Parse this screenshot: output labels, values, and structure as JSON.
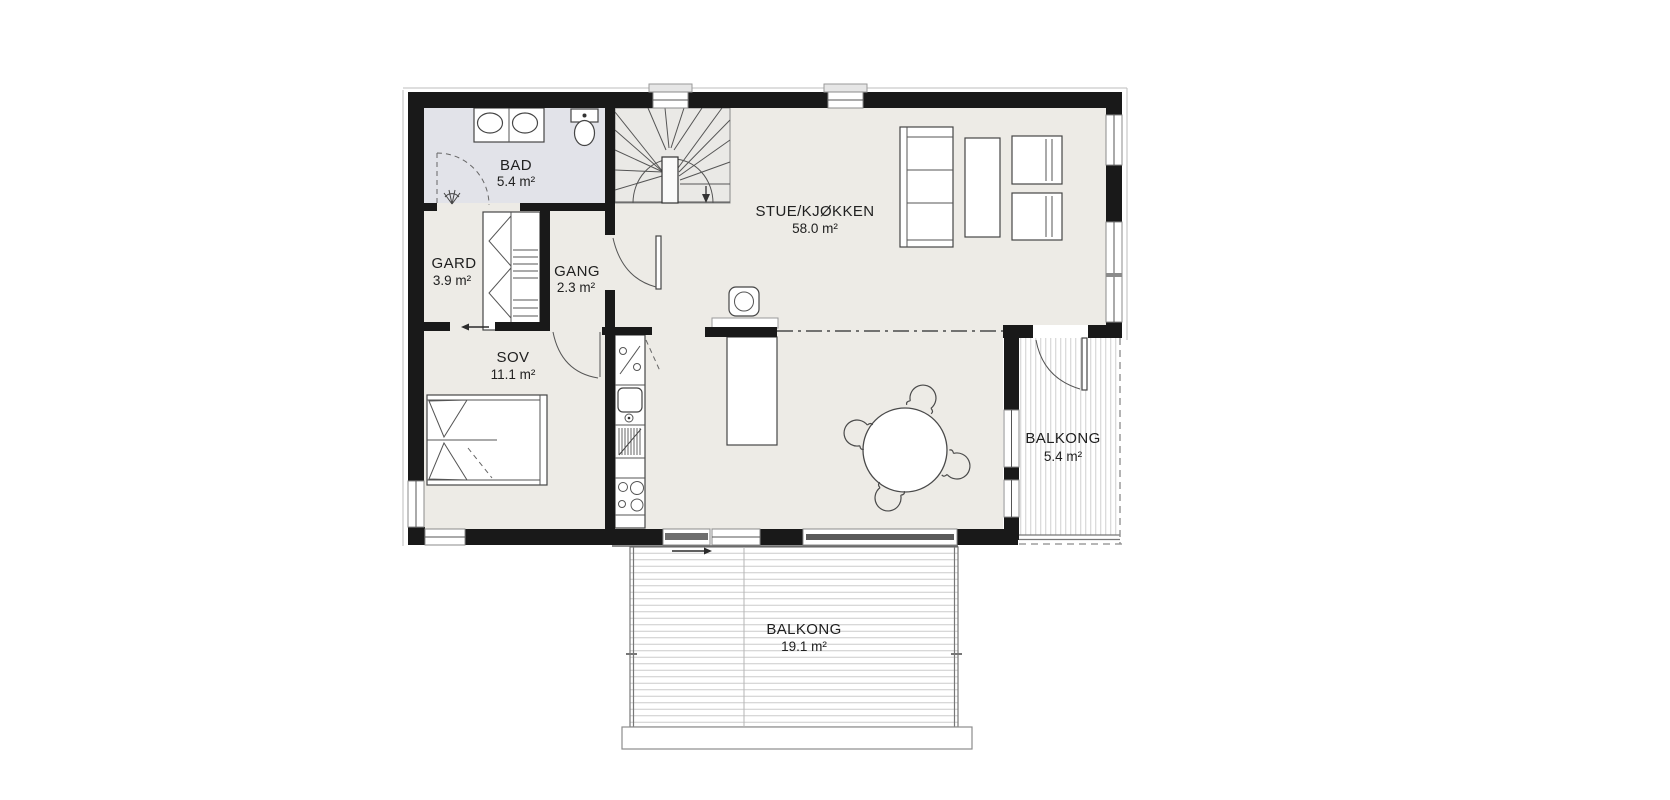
{
  "colors": {
    "wall": "#191919",
    "floor": "#edebe6",
    "bathroom_floor": "#e2e3e9",
    "deck_line": "#cccccc",
    "text": "#202020"
  },
  "rooms": {
    "bad": {
      "name": "BAD",
      "area": "5.4 m²"
    },
    "gard": {
      "name": "GARD",
      "area": "3.9 m²"
    },
    "gang": {
      "name": "GANG",
      "area": "2.3 m²"
    },
    "sov": {
      "name": "SOV",
      "area": "11.1 m²"
    },
    "stue_kjokken": {
      "name": "STUE/KJØKKEN",
      "area": "58.0 m²"
    },
    "balkong_side": {
      "name": "BALKONG",
      "area": "5.4 m²"
    },
    "balkong_front": {
      "name": "BALKONG",
      "area": "19.1 m²"
    }
  }
}
